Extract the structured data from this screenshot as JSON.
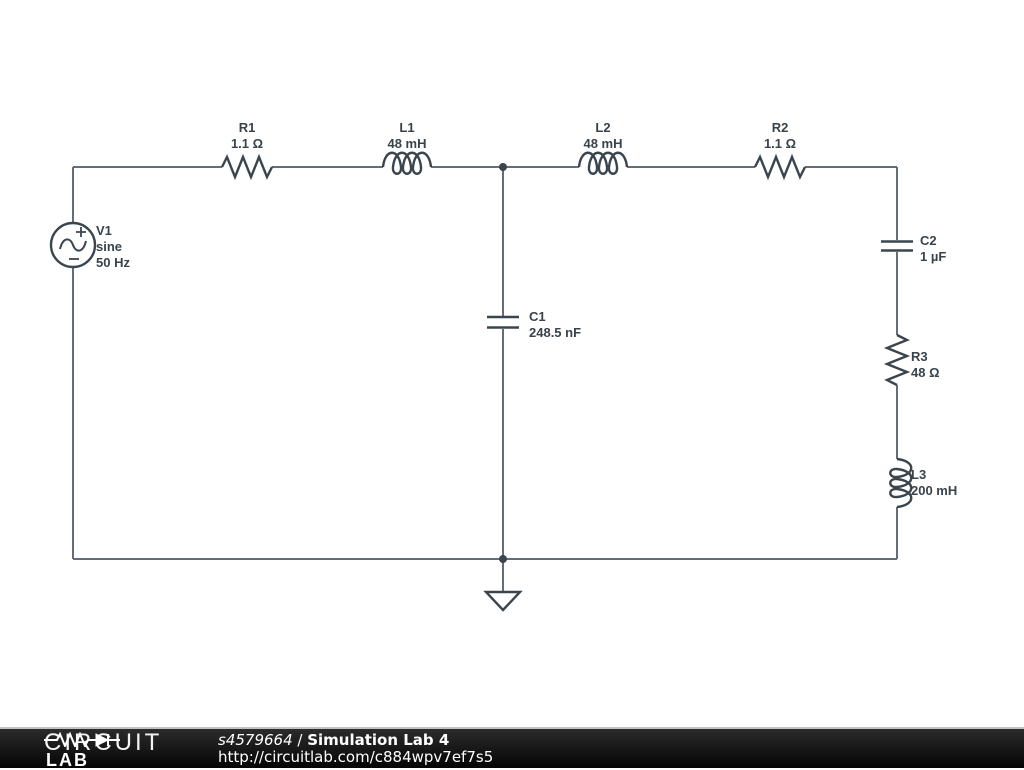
{
  "schematic": {
    "components": {
      "v1": {
        "name": "V1",
        "kind": "sine",
        "value": "50 Hz"
      },
      "r1": {
        "name": "R1",
        "value": "1.1 Ω"
      },
      "l1": {
        "name": "L1",
        "value": "48 mH"
      },
      "l2": {
        "name": "L2",
        "value": "48 mH"
      },
      "r2": {
        "name": "R2",
        "value": "1.1 Ω"
      },
      "c1": {
        "name": "C1",
        "value": "248.5 nF"
      },
      "c2": {
        "name": "C2",
        "value": "1 µF"
      },
      "r3": {
        "name": "R3",
        "value": "48 Ω"
      },
      "l3": {
        "name": "L3",
        "value": "200 mH"
      }
    },
    "colors": {
      "wire": "#646e76",
      "symbol": "#3b454e",
      "label": "#39434c",
      "background": "#ffffff"
    }
  },
  "footer": {
    "brand_top": "CIRCUIT",
    "brand_bottom": "LAB",
    "circuit_id": "s4579664",
    "separator": " / ",
    "circuit_title": "Simulation Lab 4",
    "url": "http://circuitlab.com/c884wpv7ef7s5",
    "bg_color": "#0b0b0b",
    "text_color": "#ffffff"
  }
}
